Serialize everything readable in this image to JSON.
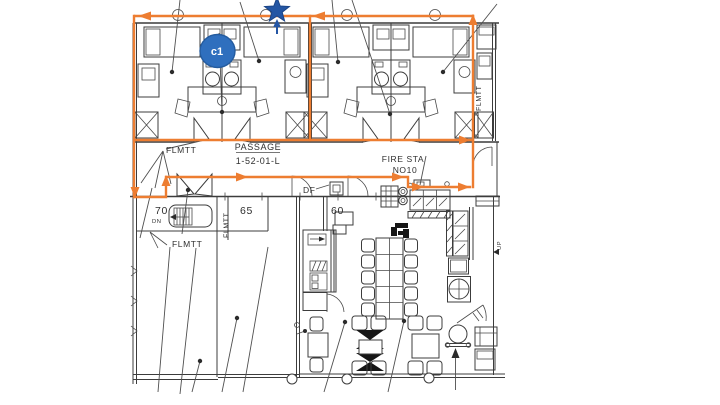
{
  "annotations": {
    "marker_label": "c1",
    "marker_fill": "#2f6fbe",
    "marker_border": "#245b9e",
    "star_color": "#2456a4",
    "highlight_color": "#ED7D31"
  },
  "floorplan": {
    "labels": {
      "flmtt_passage": "FLMTT",
      "flmtt_lower": "FLMTT",
      "flmtt_vertical_left": "FLMTT",
      "flmtt_vertical_right": "FLMTT",
      "passage_name": "PASSAGE",
      "passage_code": "1-52-01-L",
      "fire_sta_line1": "FIRE STA",
      "fire_sta_line2": "NO10",
      "df": "DF",
      "dn": "DN",
      "up": "UP",
      "room_70": "70",
      "room_65": "65",
      "room_60": "60"
    }
  }
}
